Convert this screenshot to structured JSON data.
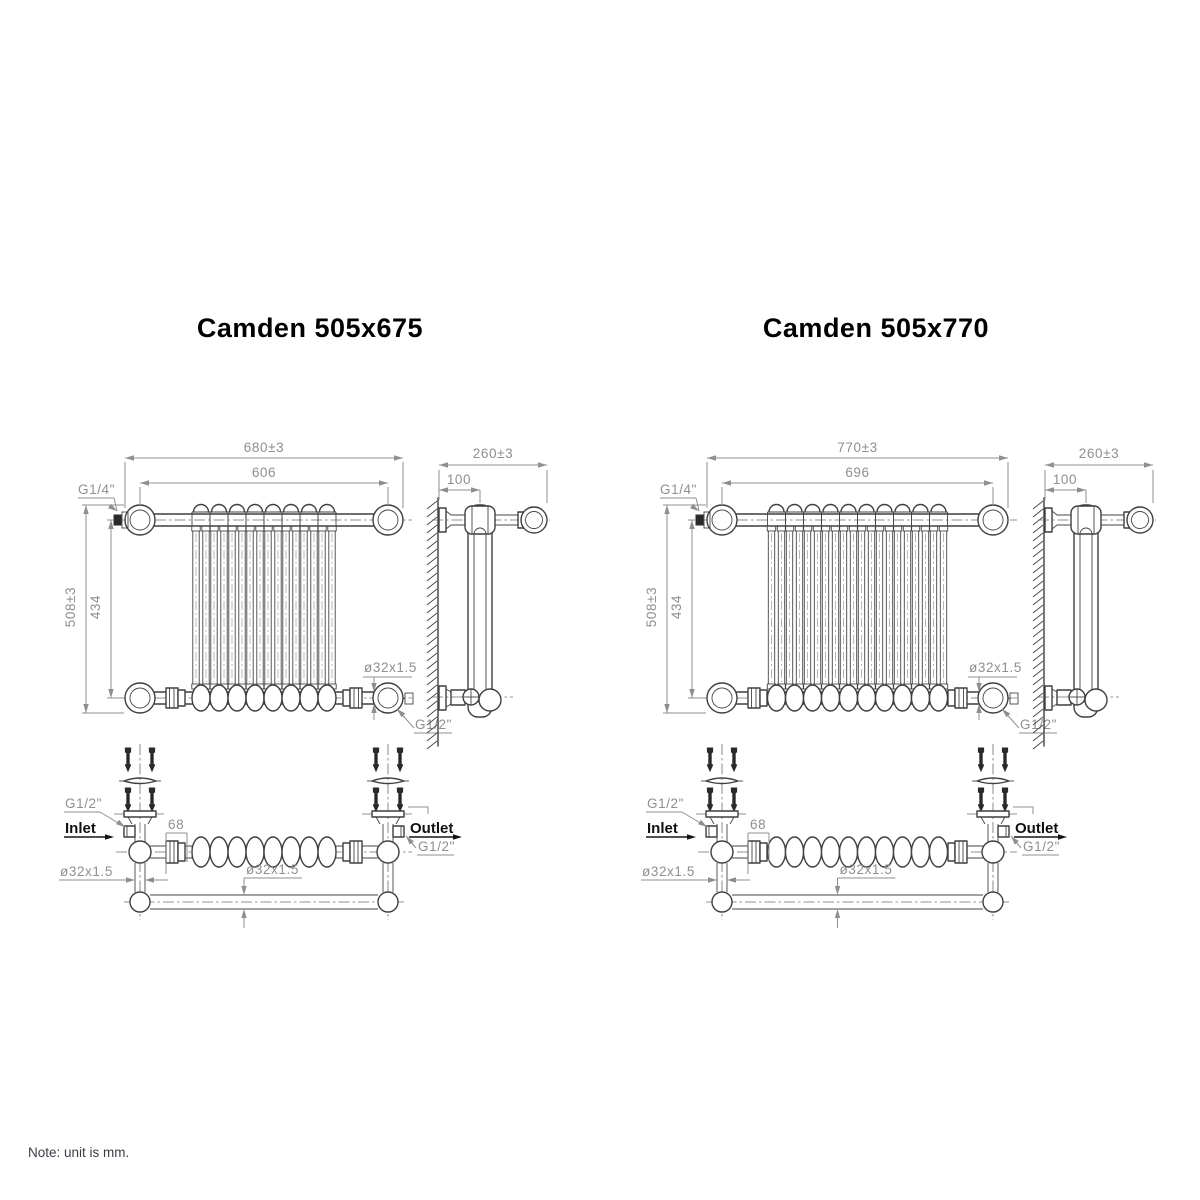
{
  "page": {
    "note": "Note: unit is mm.",
    "background": "#ffffff"
  },
  "colors": {
    "object_line": "#3f3f3f",
    "dimension": "#8f8f8f",
    "label": "#121212"
  },
  "units": [
    {
      "title": "Camden 505x675",
      "sections": 8,
      "front": {
        "overall_width": "680±3",
        "rail_pitch": "606",
        "vent_thread": "G1/4\"",
        "overall_height": "508±3",
        "inner_height": "434",
        "tube_size": "ø32x1.5",
        "drain_thread": "G1/2\""
      },
      "side": {
        "overall_depth": "260±3",
        "wall_to_column": "100"
      },
      "plan": {
        "inlet_thread": "G1/2\"",
        "inlet_label": "Inlet",
        "union_width": "68",
        "outlet_label": "Outlet",
        "outlet_thread": "G1/2\"",
        "riser_tube_size": "ø32x1.5",
        "rail_tube_size": "ø32x1.5"
      }
    },
    {
      "title": "Camden 505x770",
      "sections": 10,
      "front": {
        "overall_width": "770±3",
        "rail_pitch": "696",
        "vent_thread": "G1/4\"",
        "overall_height": "508±3",
        "inner_height": "434",
        "tube_size": "ø32x1.5",
        "drain_thread": "G1/2\""
      },
      "side": {
        "overall_depth": "260±3",
        "wall_to_column": "100"
      },
      "plan": {
        "inlet_thread": "G1/2\"",
        "inlet_label": "Inlet",
        "union_width": "68",
        "outlet_label": "Outlet",
        "outlet_thread": "G1/2\"",
        "riser_tube_size": "ø32x1.5",
        "rail_tube_size": "ø32x1.5"
      }
    }
  ]
}
